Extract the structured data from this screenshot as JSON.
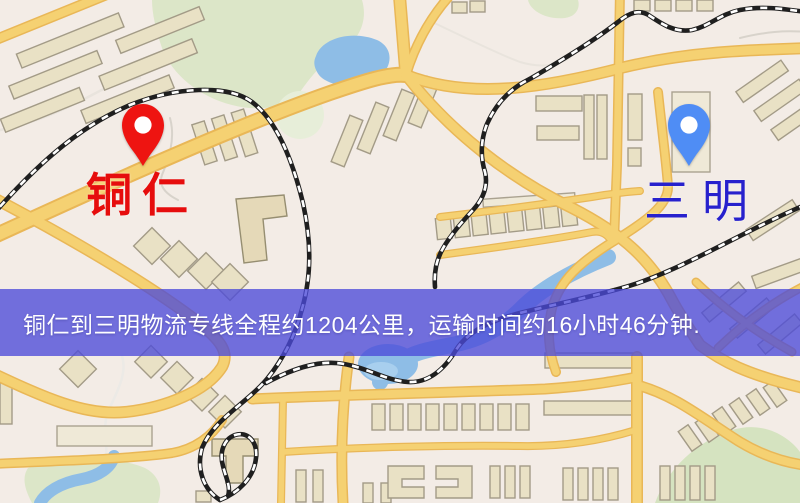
{
  "map": {
    "origin_marker": {
      "label": "铜仁",
      "pin_color": "#ee1411",
      "label_color": "#e60d0d"
    },
    "destination_marker": {
      "label": "三明",
      "pin_color": "#4f8df5",
      "label_color": "#2721cd"
    }
  },
  "banner": {
    "text": "铜仁到三明物流专线全程约1204公里，运输时间约16小时46分钟.",
    "background_color": "#4c4ad8",
    "text_color": "#ffffff",
    "route": {
      "origin": "铜仁",
      "destination": "三明",
      "service_type": "物流专线",
      "distance": "约1204公里",
      "duration": "约16小时46分钟"
    }
  },
  "map_colors": {
    "background": "#f3ece6",
    "road": "#f5d172",
    "road_casing": "#e9b757",
    "building": "#e9e1c5",
    "park": "#dce6c8",
    "water": "#8ebde6",
    "railway": "#1f1f1f"
  }
}
